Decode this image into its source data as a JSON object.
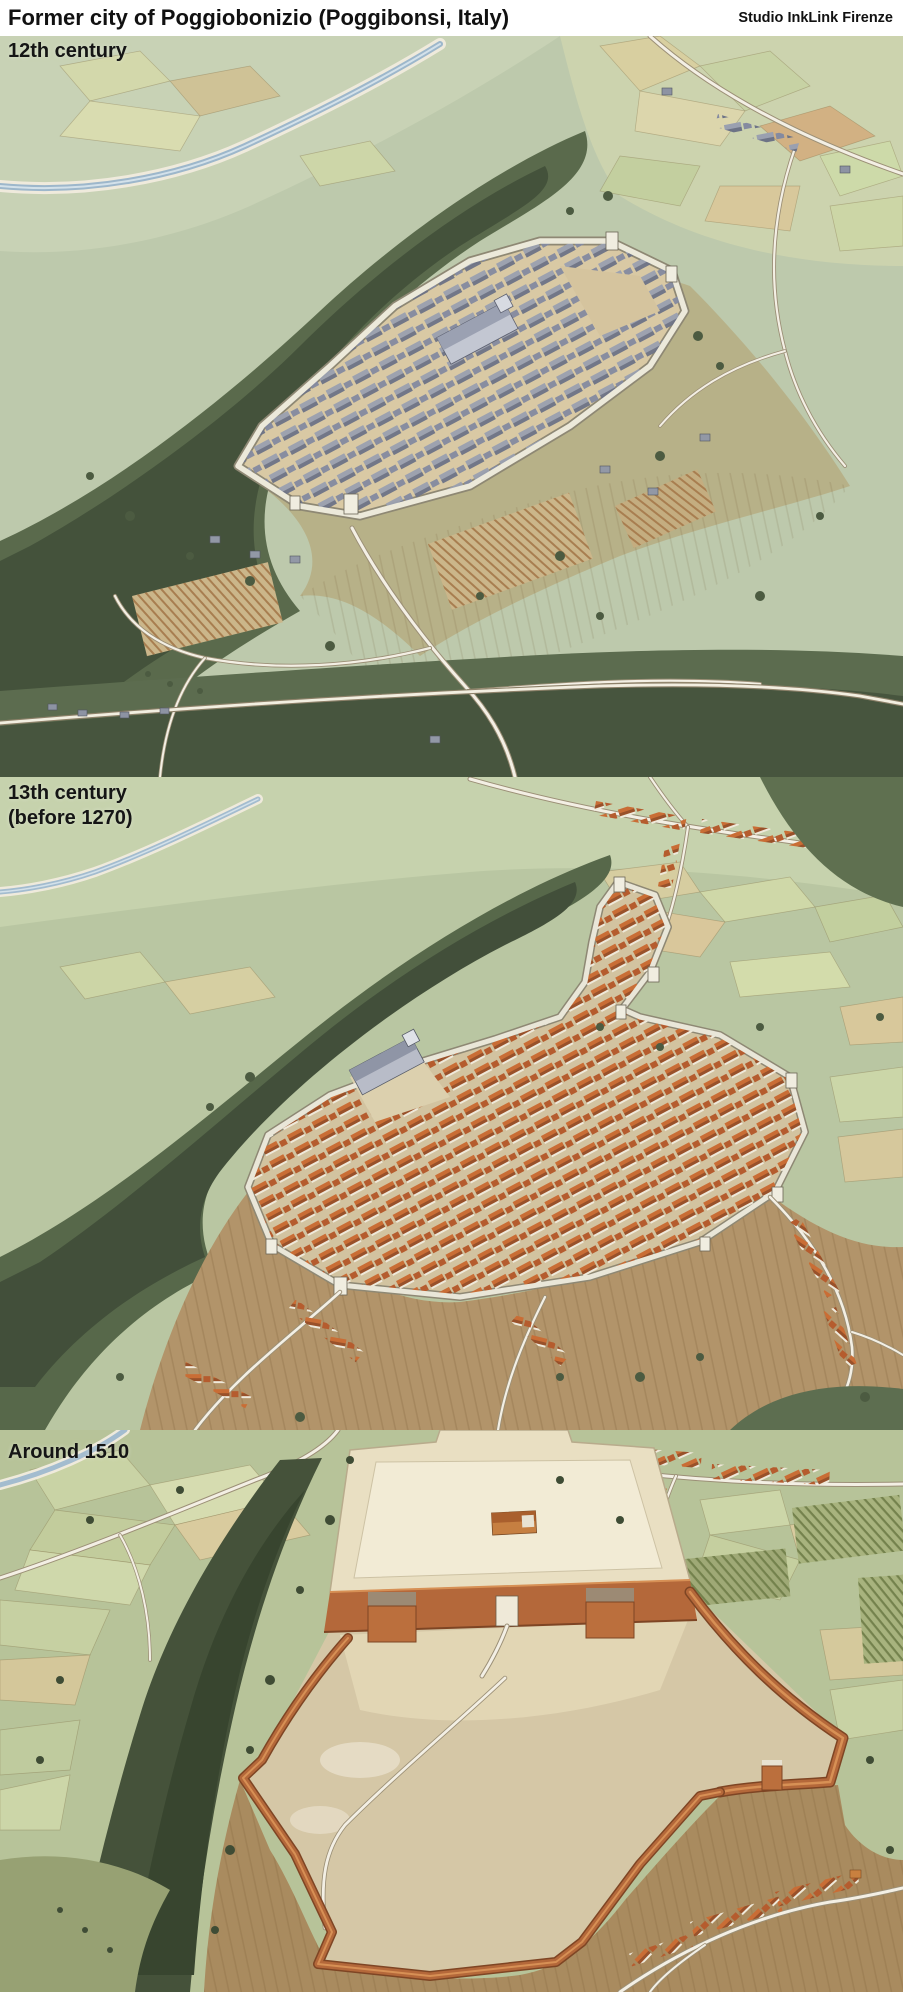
{
  "header": {
    "title": "Former city of Poggiobonizio (Poggibonsi, Italy)",
    "credit": "Studio InkLink Firenze"
  },
  "panels": [
    {
      "id": "12th-century",
      "label": "12th century"
    },
    {
      "id": "13th-century",
      "label": "13th century\n(before 1270)"
    },
    {
      "id": "around-1510",
      "label": "Around 1510"
    }
  ],
  "palette": {
    "paper": "#ffffff",
    "ink": "#151515",
    "plain_green": "#bdc9ac",
    "meadow_green": "#c6d2ad",
    "field_tan": "#d8c79d",
    "field_gold": "#d2b183",
    "forest_dark": "#44523b",
    "forest_mid": "#5a6a4c",
    "river_blue": "#a3bccf",
    "road_white": "#f3efe4",
    "wall_stone": "#e9e6d8",
    "town_ground": "#d9c9a4",
    "roof_gray": "#868ca0",
    "roof_terracotta": "#b55c2e",
    "brick_red": "#b4683a",
    "platform_cream": "#e9dfc2",
    "bare_earth": "#d3c5a6",
    "slope_brown": "#ab8d60"
  }
}
